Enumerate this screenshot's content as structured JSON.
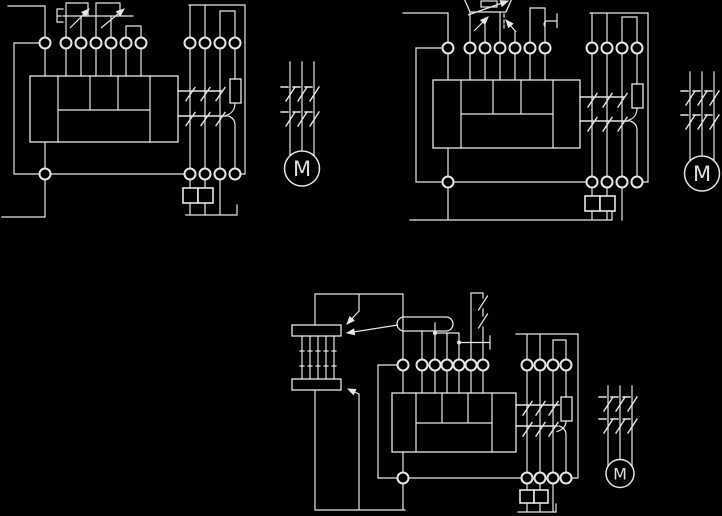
{
  "colors": {
    "background": "#000000",
    "line": "#e6e6e6"
  },
  "diagrams": [
    {
      "id": "wiring-diagram-top-left",
      "motor_label": "M"
    },
    {
      "id": "wiring-diagram-top-right",
      "motor_label": "M"
    },
    {
      "id": "wiring-diagram-bottom",
      "motor_label": "M"
    }
  ]
}
